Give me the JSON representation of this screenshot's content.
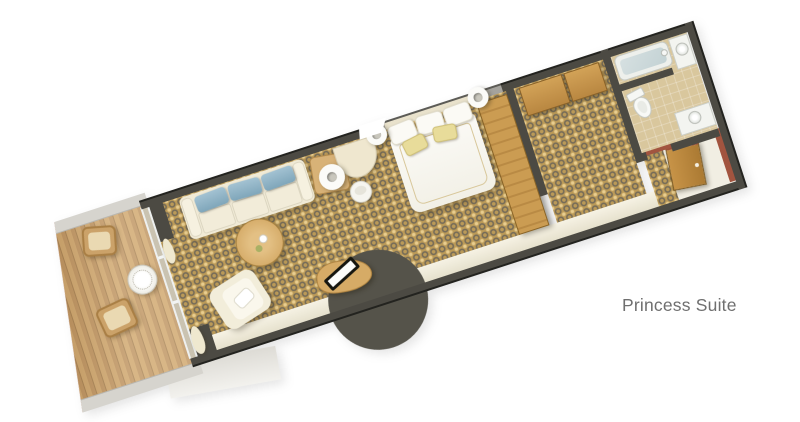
{
  "label": {
    "text": "Princess Suite",
    "color": "#6f6f6f"
  },
  "floorplan": {
    "name": "Princess Suite",
    "view": "top-down 3D rendered cruise-ship stateroom plan, rotated approximately -18 degrees",
    "rooms": [
      {
        "name": "balcony",
        "floor": "teak plank decking",
        "furniture": [
          "wicker chair",
          "wicker chair",
          "round white table"
        ],
        "edge": "white hull band with red-brown rail stripe"
      },
      {
        "name": "living-area",
        "floor": "gold patterned carpet",
        "furniture": [
          "cream sofa with three blue cushions",
          "side table with white ring lamp",
          "round wood coffee table with tea set",
          "cream armchair with white pillow",
          "curved desk with black-framed tray",
          "vanity desk with white chair"
        ]
      },
      {
        "name": "bedroom",
        "floor": "gold patterned carpet",
        "furniture": [
          "queen bed with white duvet",
          "three white pillows",
          "two yellow accent pillows",
          "two white ring bedside lamps",
          "wood wardrobe"
        ]
      },
      {
        "name": "dressing-area",
        "floor": "gold patterned carpet",
        "furniture": [
          "two wood closets"
        ]
      },
      {
        "name": "bathroom",
        "floor": "beige tile",
        "furniture": [
          "bathtub with glass screen",
          "washbasin counter",
          "toilet",
          "vanity sink"
        ]
      },
      {
        "name": "entry",
        "floor": "cream with carpet runner",
        "furniture": [
          "open wood entry door"
        ]
      }
    ],
    "colors": {
      "wall_dark": "#4c4a43",
      "carpet_gold": "#bb9a58",
      "carpet_pattern": "#4a4e58",
      "deck_wood": "#b68549",
      "hull_stripe": "#ad5947",
      "cushion_blue": "#8fb3c5",
      "pillow_yellow": "#e8dc9a",
      "fixture_white": "#f4f5f2",
      "background": "#ffffff"
    }
  }
}
